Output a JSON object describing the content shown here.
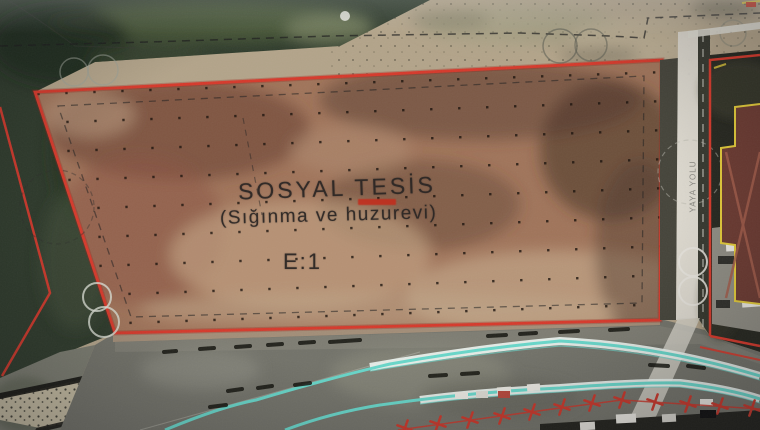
{
  "map": {
    "parcel_label": {
      "title": "SOSYAL TESİS",
      "subtitle": "(Sığınma ve huzurevi)",
      "floor_area_ratio": "E:1"
    },
    "pedestrian_way_label": "YAYA YOLU",
    "colors": {
      "parcel_boundary_red": "#d6392b",
      "setback_dash_black": "#1f1f1f",
      "rail_line_cyan": "#68d6c9",
      "building_outline_yellow": "#e2ca39",
      "roadside_tree_marker_red": "#c8372a",
      "pedestrian_way_white": "#dedbd2",
      "label_text": "#2a2624"
    }
  }
}
